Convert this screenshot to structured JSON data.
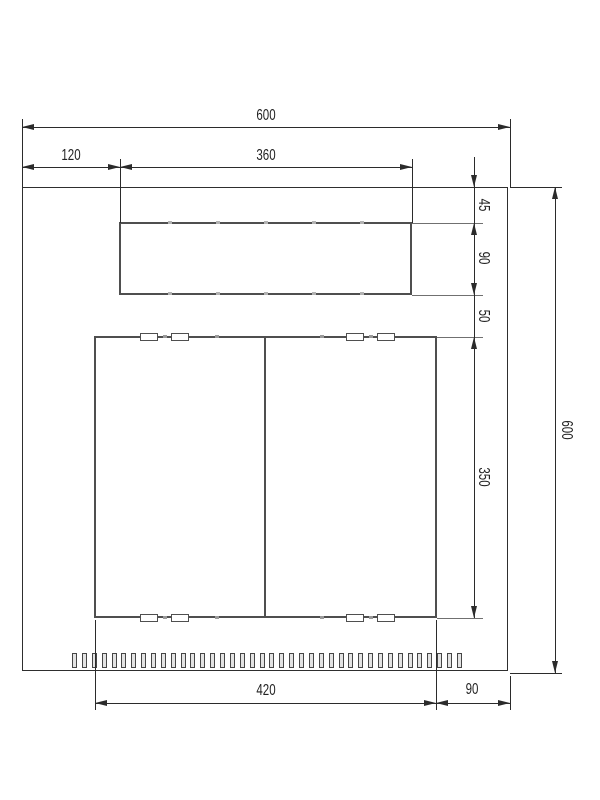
{
  "drawing": {
    "dimensions": {
      "top_total_width": "600",
      "top_left_offset": "120",
      "top_cutout_width": "360",
      "top_margin": "45",
      "top_cutout_height": "90",
      "gap_below_cutout": "50",
      "door_height": "350",
      "right_total_height": "600",
      "door_width": "420",
      "bottom_right_margin": "90"
    },
    "features": {
      "vent_slot_count": 40,
      "edge_slot_count_per_edge": 4,
      "weld_tick_count_per_edge": 5
    },
    "colors": {
      "dimension_line": "#2b2b2b",
      "shape_line": "#4f4f4f",
      "background": "#ffffff"
    }
  }
}
